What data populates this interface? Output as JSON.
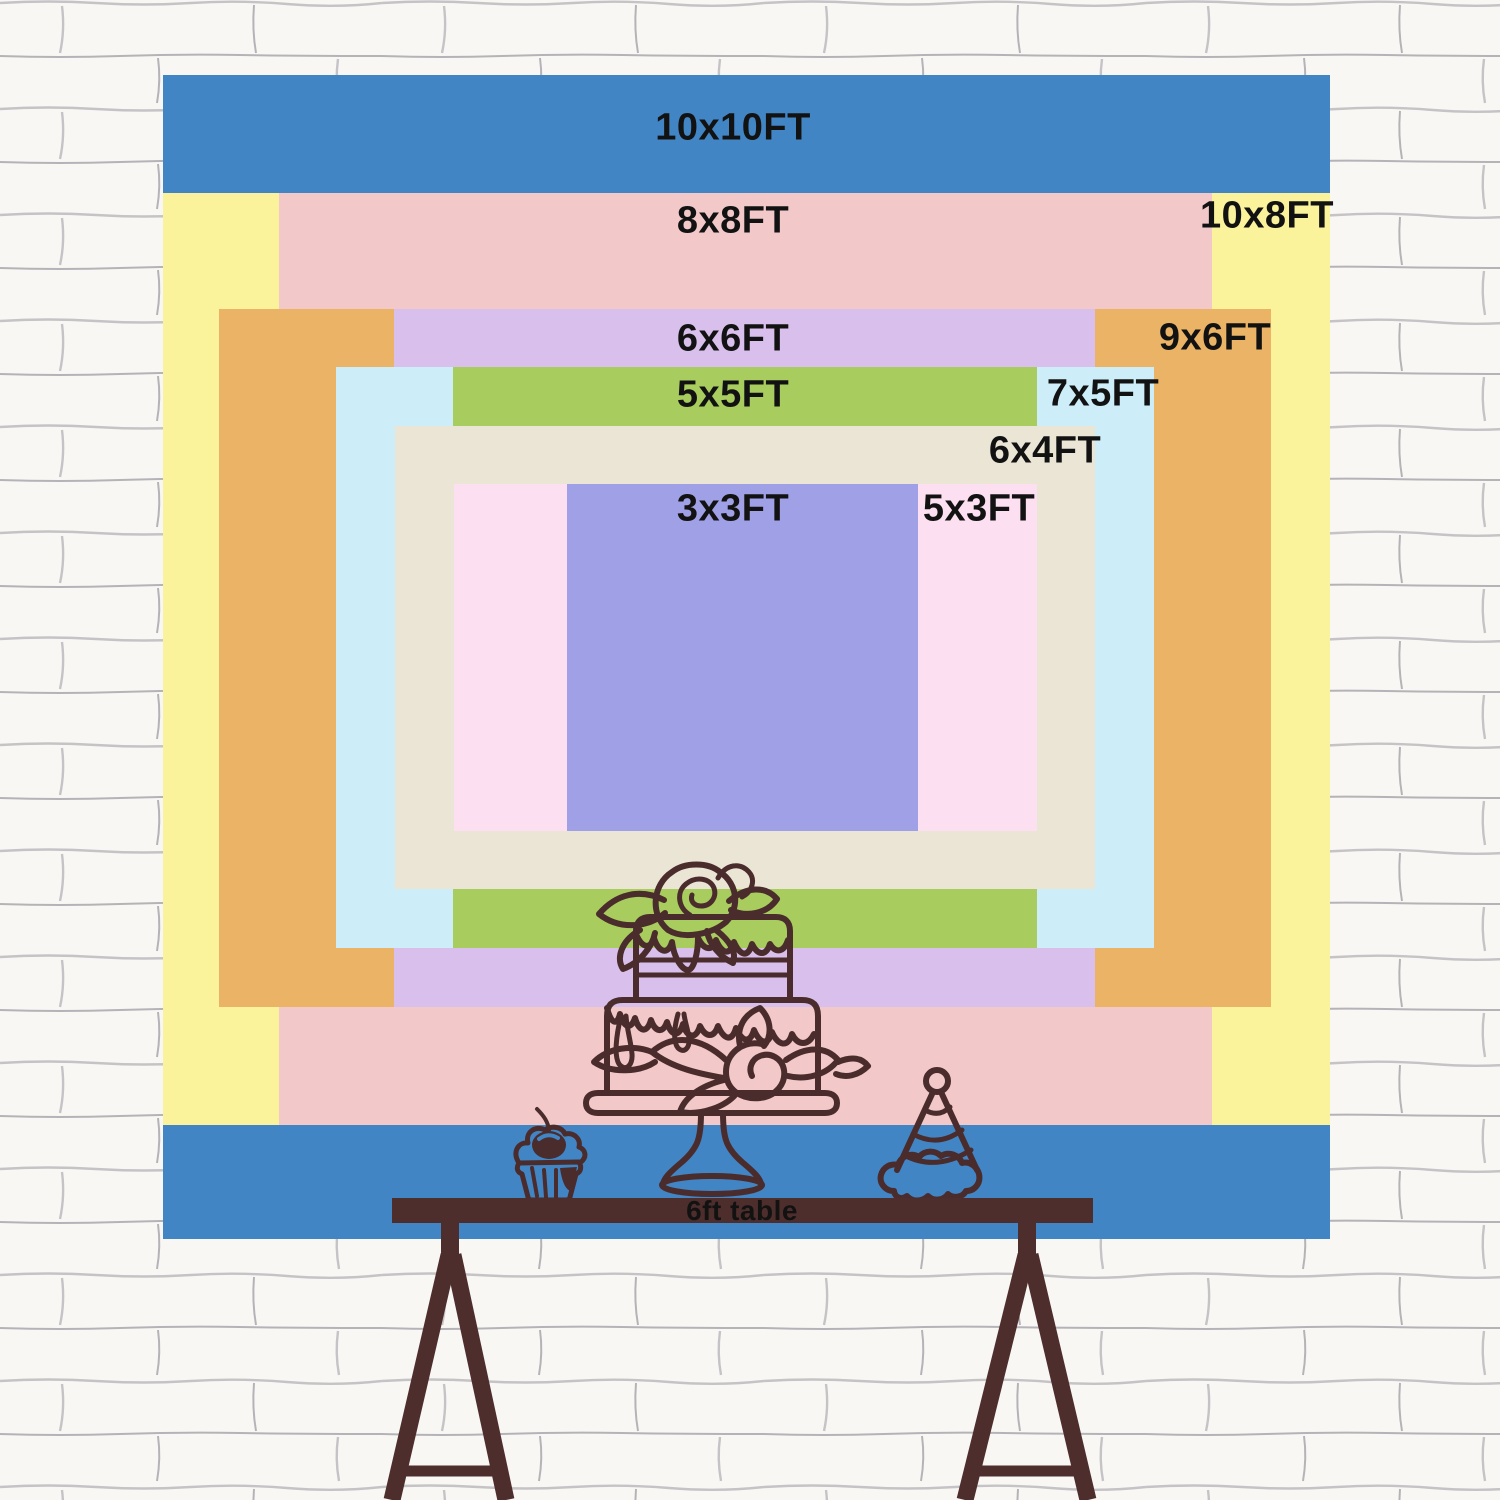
{
  "poster": {
    "sizes": [
      {
        "id": "10x10",
        "label": "10x10FT"
      },
      {
        "id": "8x8",
        "label": "8x8FT"
      },
      {
        "id": "10x8",
        "label": "10x8FT"
      },
      {
        "id": "6x6",
        "label": "6x6FT"
      },
      {
        "id": "9x6",
        "label": "9x6FT"
      },
      {
        "id": "5x5",
        "label": "5x5FT"
      },
      {
        "id": "7x5",
        "label": "7x5FT"
      },
      {
        "id": "6x4",
        "label": "6x4FT"
      },
      {
        "id": "3x3",
        "label": "3x3FT"
      },
      {
        "id": "5x3",
        "label": "5x3FT"
      }
    ],
    "table_label": "6ft table",
    "illustrations": [
      "birthday-cake-on-stand",
      "cupcake-with-cherry",
      "party-hat"
    ]
  },
  "colors": {
    "size_10x10": "#4285c5",
    "size_10x8": "#faf39c",
    "size_8x8": "#f2c8c9",
    "size_9x6": "#eab366",
    "size_6x6": "#d9c0ec",
    "size_7x5": "#cdeef8",
    "size_5x5": "#a8cc5e",
    "size_6x4": "#ebe5d6",
    "size_5x3": "#fcdff0",
    "size_3x3": "#9fa0e6",
    "label_text": "#121212",
    "table": "#4e2e2c",
    "line_art": "#4a2c2c",
    "wall": "#f8f7f4",
    "mortar": "#a9a8ae"
  }
}
